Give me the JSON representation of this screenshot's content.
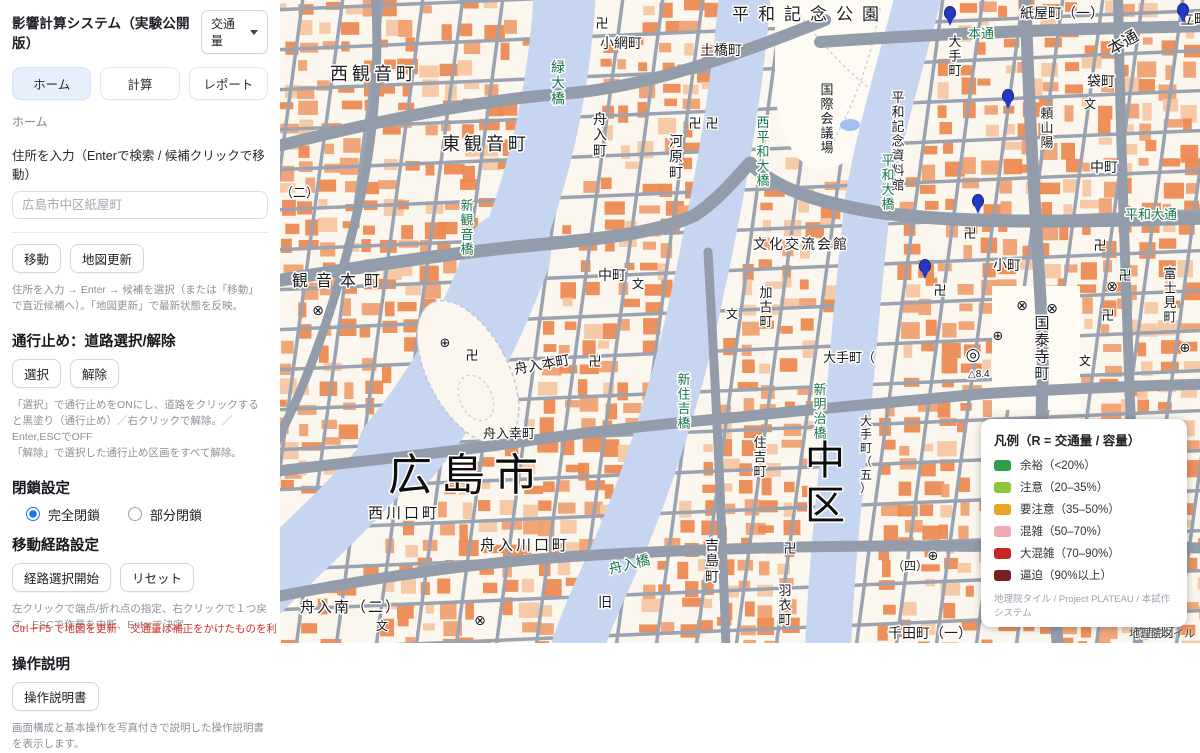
{
  "app": {
    "title": "影響計算システム（実験公開版）",
    "mode_value": "交通量",
    "tabs": [
      {
        "label": "ホーム",
        "active": true
      },
      {
        "label": "計算",
        "active": false
      },
      {
        "label": "レポート",
        "active": false
      }
    ],
    "breadcrumb": "ホーム"
  },
  "address": {
    "label": "住所を入力（Enterで検索 / 候補クリックで移動）",
    "placeholder": "広島市中区紙屋町",
    "move_button": "移動",
    "update_button": "地図更新",
    "help": "住所を入力 → Enter → 候補を選択（または「移動」で直近候補へ）。「地図更新」で最新状態を反映。"
  },
  "road_closure": {
    "heading": "通行止め：道路選択/解除",
    "select_button": "選択",
    "clear_button": "解除",
    "help1": "「選択」で通行止めをONにし、道路をクリックすると黒塗り（通行止め）／右クリックで解除。／Enter,ESCでOFF",
    "help2": "「解除」で選択した通行止め区画をすべて解除。"
  },
  "closure": {
    "heading": "閉鎖設定",
    "options": [
      {
        "label": "完全閉鎖",
        "selected": true
      },
      {
        "label": "部分閉鎖",
        "selected": false
      }
    ]
  },
  "route": {
    "heading": "移動経路設定",
    "start_button": "経路選択開始",
    "reset_button": "リセット",
    "help": "左クリックで端点/折れ点の指定、右クリックで１つ戻す、ESCで作業を中断、Enterで決定"
  },
  "manual": {
    "heading": "操作説明",
    "button": "操作説明書",
    "help": "画面構成と基本操作を写真付きで説明した操作説明書を表示します。"
  },
  "footer": {
    "note1": "Ctrl＋F5 で地図を更新",
    "note2": "交通量は補正をかけたものを利用しています"
  },
  "legend": {
    "title": "凡例（R = 交通量 / 容量）",
    "items": [
      {
        "label": "余裕（<20%）",
        "color": "#2e9e4b"
      },
      {
        "label": "注意（20–35%）",
        "color": "#8cc63c"
      },
      {
        "label": "要注意（35–50%）",
        "color": "#e9a51f"
      },
      {
        "label": "混雑（50–70%）",
        "color": "#f2a9b1"
      },
      {
        "label": "大混雑（70–90%）",
        "color": "#c52626"
      },
      {
        "label": "逼迫（90%以上）",
        "color": "#7a1f21"
      }
    ],
    "attribution": "地理院タイル / Project PLATEAU / 本試作システム"
  },
  "map": {
    "attribution": "地理院タイル",
    "labels": [
      {
        "t": "平和記念公園",
        "x": 452,
        "y": 20,
        "s": 17,
        "c": "place",
        "ls": 9
      },
      {
        "t": "小網町",
        "x": 320,
        "y": 48,
        "s": 14,
        "c": "place"
      },
      {
        "t": "土橋町",
        "x": 420,
        "y": 55,
        "s": 14,
        "c": "place"
      },
      {
        "t": "西観音町",
        "x": 50,
        "y": 80,
        "s": 18,
        "c": "place",
        "ls": 4
      },
      {
        "t": "東観音町",
        "x": 162,
        "y": 150,
        "s": 18,
        "c": "place",
        "ls": 4
      },
      {
        "t": "（二）",
        "x": 0,
        "y": 197,
        "s": 13,
        "c": "place"
      },
      {
        "t": "舟入町",
        "x": 320,
        "y": 124,
        "s": 14,
        "c": "place",
        "v": 1
      },
      {
        "t": "河原町",
        "x": 396,
        "y": 146,
        "s": 14,
        "c": "place",
        "v": 1
      },
      {
        "t": "国際会議場",
        "x": 547,
        "y": 94,
        "s": 13,
        "c": "place",
        "v": 1
      },
      {
        "t": "平和記念資料館",
        "x": 618,
        "y": 102,
        "s": 13,
        "c": "place",
        "v": 1
      },
      {
        "t": "大手町",
        "x": 675,
        "y": 46,
        "s": 13,
        "c": "place",
        "v": 1
      },
      {
        "t": "紙屋町（一）",
        "x": 740,
        "y": 18,
        "s": 14,
        "c": "place"
      },
      {
        "t": "立町",
        "x": 900,
        "y": 24,
        "s": 14,
        "c": "place"
      },
      {
        "t": "本通",
        "x": 688,
        "y": 38,
        "s": 13,
        "c": "bridge"
      },
      {
        "t": "本通",
        "x": 832,
        "y": 55,
        "s": 16,
        "c": "place",
        "r": -30
      },
      {
        "t": "袋町",
        "x": 807,
        "y": 86,
        "s": 14,
        "c": "place"
      },
      {
        "t": "頼山陽",
        "x": 767,
        "y": 118,
        "s": 13,
        "c": "place",
        "v": 1
      },
      {
        "t": "中町",
        "x": 810,
        "y": 172,
        "s": 14,
        "c": "place"
      },
      {
        "t": "平和大通",
        "x": 845,
        "y": 219,
        "s": 13,
        "c": "bridge"
      },
      {
        "t": "富士見町",
        "x": 890,
        "y": 278,
        "s": 13,
        "c": "place",
        "v": 1
      },
      {
        "t": "小町",
        "x": 713,
        "y": 270,
        "s": 14,
        "c": "place"
      },
      {
        "t": "国泰寺町",
        "x": 762,
        "y": 328,
        "s": 15,
        "c": "place",
        "v": 1
      },
      {
        "t": "△8.4",
        "x": 688,
        "y": 377,
        "s": 10,
        "c": "place"
      },
      {
        "t": "（四）",
        "x": 612,
        "y": 570,
        "s": 12,
        "c": "place"
      },
      {
        "t": "観音本町",
        "x": 12,
        "y": 286,
        "s": 16,
        "c": "place",
        "ls": 8
      },
      {
        "t": "舟入本町",
        "x": 235,
        "y": 374,
        "s": 14,
        "c": "place",
        "r": -10
      },
      {
        "t": "中町",
        "x": 318,
        "y": 280,
        "s": 14,
        "c": "place"
      },
      {
        "t": "文化交流会館",
        "x": 473,
        "y": 249,
        "s": 14,
        "c": "place",
        "ls": 2
      },
      {
        "t": "加古町",
        "x": 486,
        "y": 297,
        "s": 13,
        "c": "place",
        "v": 1
      },
      {
        "t": "大手町（",
        "x": 543,
        "y": 362,
        "s": 13,
        "c": "place"
      },
      {
        "t": "大手町（五）",
        "x": 586,
        "y": 425,
        "s": 12,
        "c": "place",
        "v": 1
      },
      {
        "t": "住吉町",
        "x": 480,
        "y": 447,
        "s": 13,
        "c": "place",
        "v": 1
      },
      {
        "t": "吉島町",
        "x": 432,
        "y": 550,
        "s": 14,
        "c": "place",
        "v": 1
      },
      {
        "t": "羽衣町",
        "x": 505,
        "y": 595,
        "s": 13,
        "c": "place",
        "v": 1
      },
      {
        "t": "舟入幸町",
        "x": 203,
        "y": 438,
        "s": 13,
        "c": "place"
      },
      {
        "t": "西川口町",
        "x": 88,
        "y": 518,
        "s": 15,
        "c": "place",
        "ls": 3
      },
      {
        "t": "舟入川口町",
        "x": 200,
        "y": 550,
        "s": 15,
        "c": "place",
        "ls": 3
      },
      {
        "t": "舟入南（二）",
        "x": 20,
        "y": 612,
        "s": 15,
        "c": "place",
        "ls": 2
      },
      {
        "t": "千田町（一）",
        "x": 608,
        "y": 638,
        "s": 14,
        "c": "place"
      },
      {
        "t": "竹屋町",
        "x": 853,
        "y": 637,
        "s": 14,
        "c": "place"
      },
      {
        "t": "旧",
        "x": 318,
        "y": 607,
        "s": 14,
        "c": "place"
      },
      {
        "t": "広島市",
        "x": 108,
        "y": 490,
        "s": 44,
        "c": "big",
        "ls": 9
      },
      {
        "t": "中区",
        "x": 545,
        "y": 474,
        "s": 40,
        "c": "big",
        "v": 1
      },
      {
        "t": "緑大橋",
        "x": 278,
        "y": 72,
        "s": 14,
        "c": "bridge",
        "v": 1
      },
      {
        "t": "新観音橋",
        "x": 187,
        "y": 210,
        "s": 13,
        "c": "bridge",
        "v": 1
      },
      {
        "t": "西平和大橋",
        "x": 483,
        "y": 127,
        "s": 13,
        "c": "bridge",
        "v": 1
      },
      {
        "t": "平和大橋",
        "x": 608,
        "y": 165,
        "s": 13,
        "c": "bridge",
        "v": 1
      },
      {
        "t": "新住吉橋",
        "x": 404,
        "y": 384,
        "s": 13,
        "c": "bridge",
        "v": 1
      },
      {
        "t": "新明治橋",
        "x": 540,
        "y": 394,
        "s": 13,
        "c": "bridge",
        "v": 1
      },
      {
        "t": "舟入橋",
        "x": 330,
        "y": 574,
        "s": 14,
        "c": "bridge",
        "r": -14
      }
    ],
    "symbols": [
      {
        "g": "卍",
        "x": 322,
        "y": 28
      },
      {
        "g": "卍",
        "x": 415,
        "y": 128
      },
      {
        "g": "卍",
        "x": 432,
        "y": 128
      },
      {
        "g": "卍",
        "x": 690,
        "y": 238
      },
      {
        "g": "卍",
        "x": 660,
        "y": 295
      },
      {
        "g": "卍",
        "x": 820,
        "y": 250
      },
      {
        "g": "卍",
        "x": 845,
        "y": 280
      },
      {
        "g": "卍",
        "x": 828,
        "y": 320
      },
      {
        "g": "卍",
        "x": 315,
        "y": 366
      },
      {
        "g": "卍",
        "x": 192,
        "y": 360
      },
      {
        "g": "卍",
        "x": 510,
        "y": 553
      },
      {
        "g": "⊗",
        "x": 742,
        "y": 310
      },
      {
        "g": "⊗",
        "x": 772,
        "y": 313
      },
      {
        "g": "⊗",
        "x": 832,
        "y": 291
      },
      {
        "g": "⊗",
        "x": 38,
        "y": 315
      },
      {
        "g": "⊗",
        "x": 200,
        "y": 625
      },
      {
        "g": "⊕",
        "x": 718,
        "y": 340
      },
      {
        "g": "⊕",
        "x": 905,
        "y": 352
      },
      {
        "g": "⊕",
        "x": 165,
        "y": 347
      },
      {
        "g": "⊕",
        "x": 653,
        "y": 560
      },
      {
        "g": "文",
        "x": 358,
        "y": 288
      },
      {
        "g": "文",
        "x": 805,
        "y": 365
      },
      {
        "g": "文",
        "x": 810,
        "y": 108
      },
      {
        "g": "文",
        "x": 452,
        "y": 318
      },
      {
        "g": "文",
        "x": 102,
        "y": 630
      },
      {
        "g": "◎",
        "x": 693,
        "y": 360
      }
    ],
    "pins": [
      [
        728,
        103
      ],
      [
        698,
        208
      ],
      [
        670,
        20
      ],
      [
        903,
        17
      ],
      [
        645,
        273
      ]
    ]
  }
}
